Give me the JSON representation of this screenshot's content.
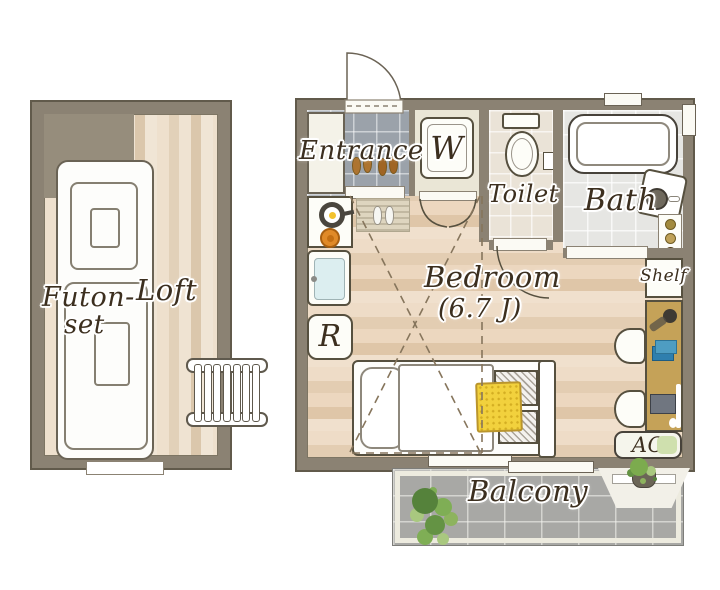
{
  "title": "One-room apartment floor plan with loft",
  "labels": {
    "entrance": "Entrance",
    "washer": "W",
    "toilet": "Toilet",
    "bath": "Bath",
    "bedroom": "Bedroom",
    "bedroom_size": "(6.7 J)",
    "fridge": "R",
    "shelf": "Shelf",
    "ac": "AC",
    "balcony": "Balcony",
    "futon_line1": "Futon-",
    "futon_line2": "set",
    "loft": "Loft"
  },
  "colors": {
    "wall": "#8b8273",
    "wall_outline": "#615a4b",
    "bedroom_wood_floor": "#ead6bf",
    "loft_wood_floor": "#ead9c4",
    "entrance_tile": "#9ba2aa",
    "toilet_tile": "#eae3d7",
    "bath_tile": "#e6e6e3",
    "balcony_tile": "#a8a8a5",
    "desk": "#c5a258",
    "blanket_yellow": "#f2d13d",
    "plant_green": "#7fae55",
    "shoes_brown": "#ad7430",
    "burner_orange": "#e08a28",
    "label_ink": "#3c2f1f"
  }
}
